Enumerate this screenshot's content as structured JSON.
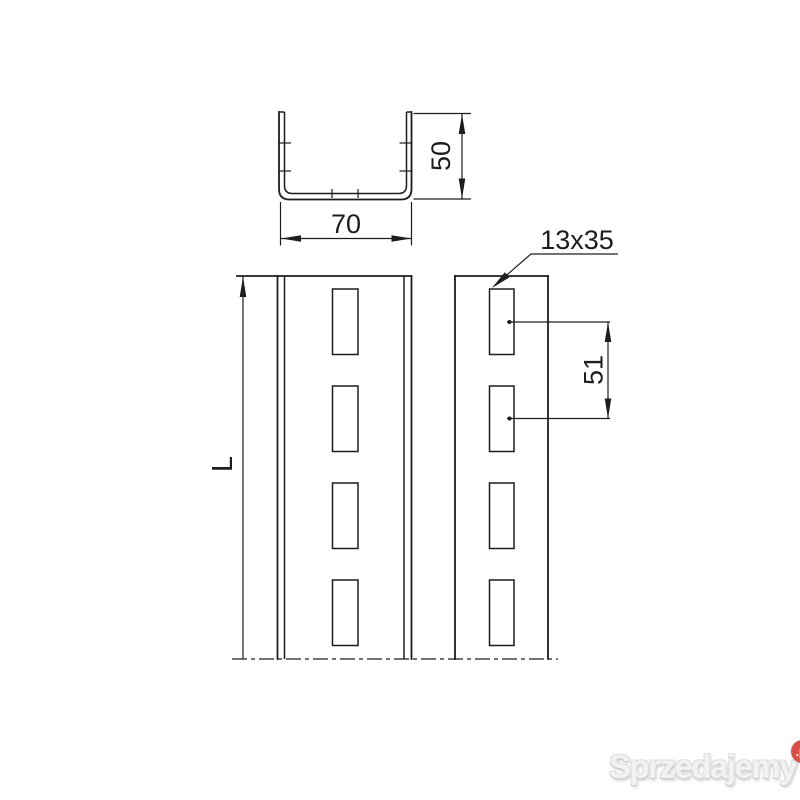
{
  "colors": {
    "bg": "#ffffff",
    "line": "#1d1d1d",
    "badge": "#d84f47",
    "wmtext": "#f2f2f2"
  },
  "drawing": {
    "cross_section": {
      "width": "70",
      "height": "50"
    },
    "profile_view": {
      "length": "L",
      "slot_size": "13x35",
      "slot_pitch": "51"
    }
  },
  "watermark": {
    "brand": "Sprzedajemy",
    "suffix": ".pl"
  }
}
